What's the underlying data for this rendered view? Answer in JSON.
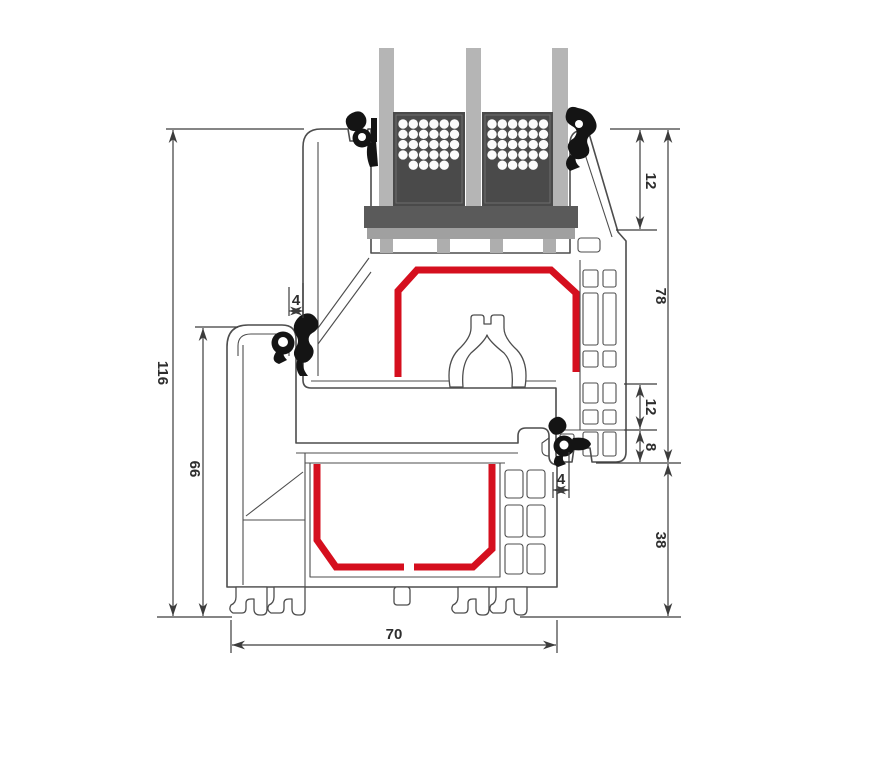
{
  "diagram": {
    "type": "window-profile-cross-section",
    "labels": {
      "total_height": "116",
      "frame_height": "66",
      "gasket_left": "4",
      "glazing_inset": "12",
      "sash_height": "78",
      "rebate_gap": "12",
      "overlap_height": "8",
      "gasket_right": "4",
      "frame_lower_height": "38",
      "profile_depth": "70"
    }
  },
  "colors": {
    "line": "#4d4d4d",
    "dim": "#3c3c3c",
    "steel": "#d50f1e",
    "glass": "#b5b5b5",
    "block": "#4a4a4a",
    "bridge": "#5a5a5a",
    "lightbar": "#a0a0a0",
    "support": "#aeaeae",
    "gasket": "#141414",
    "text": "#2e2e2e",
    "bg": "#ffffff"
  }
}
